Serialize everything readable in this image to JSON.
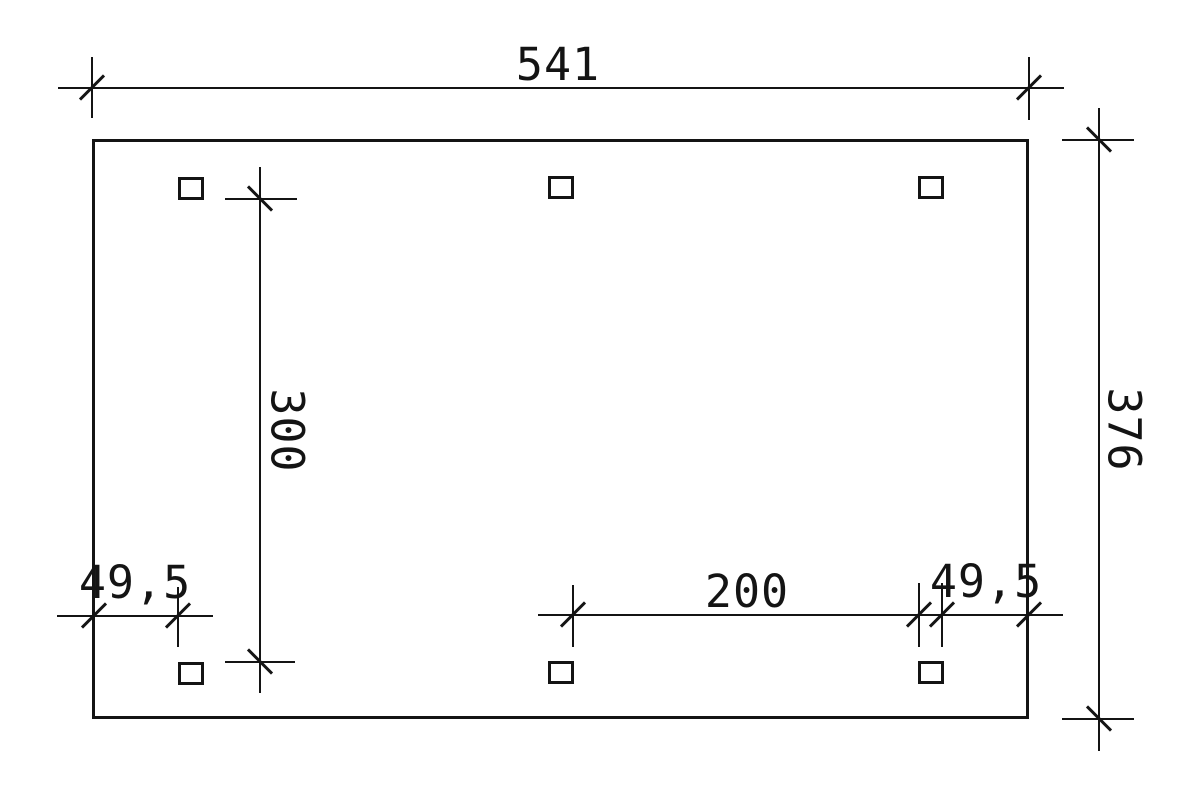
{
  "drawing": {
    "type": "technical-dimension-plan",
    "colors": {
      "line": "#141414",
      "background": "#ffffff"
    },
    "dimensions": {
      "overall_width": "541",
      "overall_depth": "376",
      "inner_post_depth": "300",
      "post_clear_span": "200",
      "left_edge_offset": "49,5",
      "right_edge_offset": "49,5"
    }
  }
}
